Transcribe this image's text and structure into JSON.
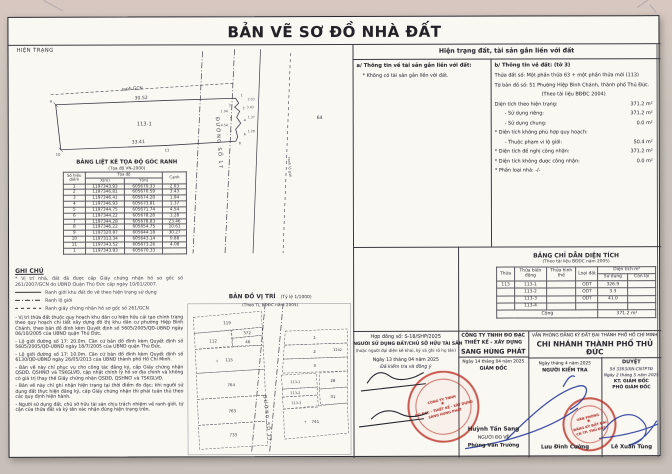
{
  "doc": {
    "title": "BẢN VẼ SƠ ĐỒ NHÀ ĐẤT",
    "hien_trang": "HIỆN TRẠNG"
  },
  "sketch": {
    "ranh_gcn": "ranh GCN",
    "dim_top": "30.52",
    "dim_bottom": "33.41",
    "parcel_label": "113-1",
    "road_label": "ĐƯỜNG SỐ 17",
    "road_note": "ranh lộ giới",
    "right_parcel": "64",
    "edges": {
      "e1": "2.03",
      "e2": "3.43",
      "e3": "1.94",
      "e4": "1.37",
      "e5": "4.54",
      "e6": "1.28"
    },
    "points": {
      "p1": "1",
      "p2": "2",
      "p3": "3",
      "p4": "4",
      "p5": "5",
      "p6": "6",
      "p7": "7",
      "p8": "8",
      "p9": "9",
      "p10": "10",
      "p11": "11"
    }
  },
  "coord_table": {
    "title": "BẢNG LIỆT KÊ TỌA ĐỘ GÓC RANH",
    "subtitle": "(Tọa độ VN-2000)",
    "col_point": "Số hiệu điểm",
    "col_group": "Tọa độ",
    "col_x": "X(m)",
    "col_y": "Y(m)",
    "col_edge": "Cạnh",
    "rows": [
      [
        "1",
        "1197343.93",
        "605670.33",
        "2.03"
      ],
      [
        "2",
        "1197346.81",
        "605670.59",
        "3.43"
      ],
      [
        "3",
        "1197346.41",
        "605674.28",
        "1.94"
      ],
      [
        "4",
        "1197346.93",
        "605673.81",
        "1.37"
      ],
      [
        "5",
        "1197344.75",
        "605671.74",
        "4.54"
      ],
      [
        "6",
        "1197344.22",
        "605678.28",
        "1.28"
      ],
      [
        "7",
        "1197344.28",
        "605678.83",
        "23.46"
      ],
      [
        "8",
        "1197346.22",
        "605654.75",
        "10.61"
      ],
      [
        "9",
        "1197320.87",
        "605644.18",
        "30.27"
      ],
      [
        "10",
        "1197313.34",
        "605643.14",
        "0.88"
      ],
      [
        "11",
        "1197343.52",
        "605673.26",
        "4.08"
      ],
      [
        "1",
        "1197343.93",
        "605670.33",
        ""
      ]
    ]
  },
  "notes": {
    "title": "GHI CHÚ",
    "intro": "* Vị trí nhà, đất đã được cấp Giấy chứng nhận hồ sơ gốc số 261/2007/GCN do UBND Quận Thủ Đức cấp ngày 10/01/2007.",
    "legend": [
      {
        "label": "Ranh giới khu đất đo vẽ theo hiện trạng sử dụng"
      },
      {
        "label": "Ranh lộ giới"
      },
      {
        "label": "Ranh giấy chứng nhận hồ sơ gốc số 261/GCN"
      }
    ],
    "paragraphs": [
      "- Vị trí thửa đất thuộc quy hoạch khu dân cư hiện hữu cải tạo chỉnh trang theo quy hoạch chi tiết xây dựng đô thị khu dân cư phường Hiệp Bình Chánh, theo bản đồ đính kèm Quyết định số 5605/2005/QĐ-UBND ngày 06/10/2005 của UBND quận Thủ Đức.",
      "- Lộ giới đường số 17: 20.0m. Căn cứ bản đồ đính kèm Quyết định số 5605/2005/QĐ-UBND ngày 18/7/2005 của UBND quận Thủ Đức.",
      "- Lộ giới đường số 17: 10.0m. Căn cứ bản đồ đính kèm Quyết định số 6130/QĐ-UBND ngày 26/05/2013 của UBND thành phố Hồ Chí Minh.",
      "- Bản vẽ này chỉ phục vụ cho công tác đăng ký, cấp Giấy chứng nhận QSDĐ, QSHNƠ và TSKGLVĐ, cập nhật chỉnh lý hồ sơ địa chính và không có giá trị thay thế Giấy chứng nhận QSDĐ, QSHNƠ và TSKGLVĐ.",
      "- Bản vẽ này chỉ ghi nhận hiện trạng tại thời điểm đo đạc; khi người sử dụng đất thực hiện đăng ký, cấp Giấy chứng nhận thì phải tuân thủ theo các quy định hiện hành.",
      "- Người sử dụng đất, chủ sở hữu tài sản chịu trách nhiệm về ranh giới, tứ cận của thửa đất và ký tên xác nhận đúng hiện trạng trên."
    ]
  },
  "location_map": {
    "title": "BẢN ĐỒ VỊ TRÍ",
    "scale": "(Tỷ lệ 1/1000)",
    "source": "(Theo TL BĐĐC năm 2005)",
    "road": "ĐƯỜNG SỐ 17",
    "parcels": {
      "p119": "119",
      "p112": "112",
      "p372": "372",
      "p46": "46",
      "p115": "115",
      "p764": "764",
      "p763": "763",
      "p733": "733",
      "p1": "1",
      "p2": "2",
      "p3": "3",
      "p1142": "1142",
      "p28": "28",
      "p31": "31",
      "p741": "741",
      "s1": "113-1",
      "s2": "113-2",
      "s3": "113-3"
    }
  },
  "land_info": {
    "band": "Hiện trạng đất, tài sản gắn liền với đất",
    "a_title": "a/ Thông tin về tài sản gắn liền với đất:",
    "a_note": "* Không có tài sản gắn liền với đất.",
    "b_title": "b/ Thông tin về đất: (tờ 3)",
    "b_lines": [
      {
        "t": "Thửa đất số: Một phần thửa 63 + một phần thửa mới (113)",
        "v": ""
      },
      {
        "t": "Tờ bản đồ số: 51 Phường Hiệp Bình Chánh, thành phố Thủ Đức.",
        "v": ""
      },
      {
        "t": "(Theo tài liệu BĐĐC 2004)",
        "v": "",
        "cls": "ctr"
      },
      {
        "t": "Diện tích theo hiện trạng:",
        "v": "371.2 m²"
      },
      {
        "t": "- Sử dụng riêng:",
        "v": "371.2 m²",
        "cls": "ind"
      },
      {
        "t": "- Sử dụng chung:",
        "v": "0.0 m²",
        "cls": "ind"
      },
      {
        "t": "* Diện tích không phù hợp quy hoạch:",
        "v": ""
      },
      {
        "t": "- Thuộc phạm vi lộ giới:",
        "v": "50.4 m²",
        "cls": "ind"
      },
      {
        "t": "* Diện tích đề nghị công nhận:",
        "v": "371.2 m²"
      },
      {
        "t": "* Diện tích không được công nhận:",
        "v": "0.0 m²"
      },
      {
        "t": "* Phân loại nhà:  -/-",
        "v": ""
      }
    ]
  },
  "area_table": {
    "title": "BẢNG CHỈ DẪN DIỆN TÍCH",
    "subtitle": "(Theo tài liệu BĐĐC năm 2005)",
    "col_thua": "Thửa",
    "col_bien_dong": "Thửa biến động",
    "col_hinh_the": "Thửa hình thể",
    "col_loai_dat": "Loại đất",
    "col_dien_tich": "Diện tích m²",
    "col_su_dung": "Sử dụng",
    "col_con_lai": "Còn lại",
    "rows": [
      [
        "113",
        "113-1",
        "",
        "ODT",
        "326.9",
        ""
      ],
      [
        "",
        "113-2",
        "",
        "ODT",
        "3.3",
        ""
      ],
      [
        "",
        "113-3",
        "",
        "ODT",
        "41.0",
        ""
      ],
      [
        "",
        "113-4",
        "",
        "",
        "",
        ""
      ]
    ],
    "total_label": "Cộng",
    "total_value": "371.2 m²"
  },
  "footer": {
    "box1": {
      "contract": "Hợp đồng số: S-18/SHP/2025",
      "role": "NGƯỜI SỬ DỤNG ĐẤT/CHỦ SỞ HỮU TÀI SẢN",
      "role_note": "(hoặc người đại diện kê khai, ký và ghi rõ họ tên)",
      "date": "Ngày 13 tháng 04 năm 2025",
      "checked": "Đã kiểm tra và đồng ý"
    },
    "box2": {
      "company1": "CÔNG TY TNHH ĐO ĐẠC",
      "company2": "THIẾT KẾ - XÂY DỰNG",
      "company3": "SANG HÙNG PHÁT",
      "date": "Ngày 14 tháng 04 năm 2025",
      "role": "GIÁM ĐỐC",
      "name": "Huỳnh Tấn Sang",
      "role2": "NGƯỜI ĐO VẼ",
      "name2": "Phùng Văn Trường"
    },
    "office": {
      "line1": "VĂN PHÒNG ĐĂNG KÝ ĐẤT ĐAI THÀNH PHỐ HỒ CHÍ MINH",
      "line2": "CHI NHÁNH THÀNH PHỐ THỦ ĐỨC"
    },
    "box3": {
      "date": "Ngày      tháng 4 năm 2025",
      "role": "NGƯỜI KIỂM TRA",
      "name": "Lưu Đình Cường"
    },
    "box4": {
      "approve": "DUYỆT",
      "number": "Số 3363/XN-CNTPTĐ",
      "date": "Ngày 2 tháng 5 năm 2025",
      "role1": "KT. GIÁM ĐỐC",
      "role2": "PHÓ GIÁM ĐỐC",
      "name": "Lê Xuân Tùng"
    }
  },
  "stamps": {
    "company_lines": [
      "CÔNG TY TNHH",
      "ĐO ĐẠC - THIẾT KẾ - XÂY DỰNG",
      "SANG HÙNG PHÁT"
    ],
    "office_lines": [
      "VĂN PHÒNG",
      "ĐĂNG KÝ ĐẤT ĐAI",
      "CN TP. THỦ ĐỨC"
    ]
  }
}
